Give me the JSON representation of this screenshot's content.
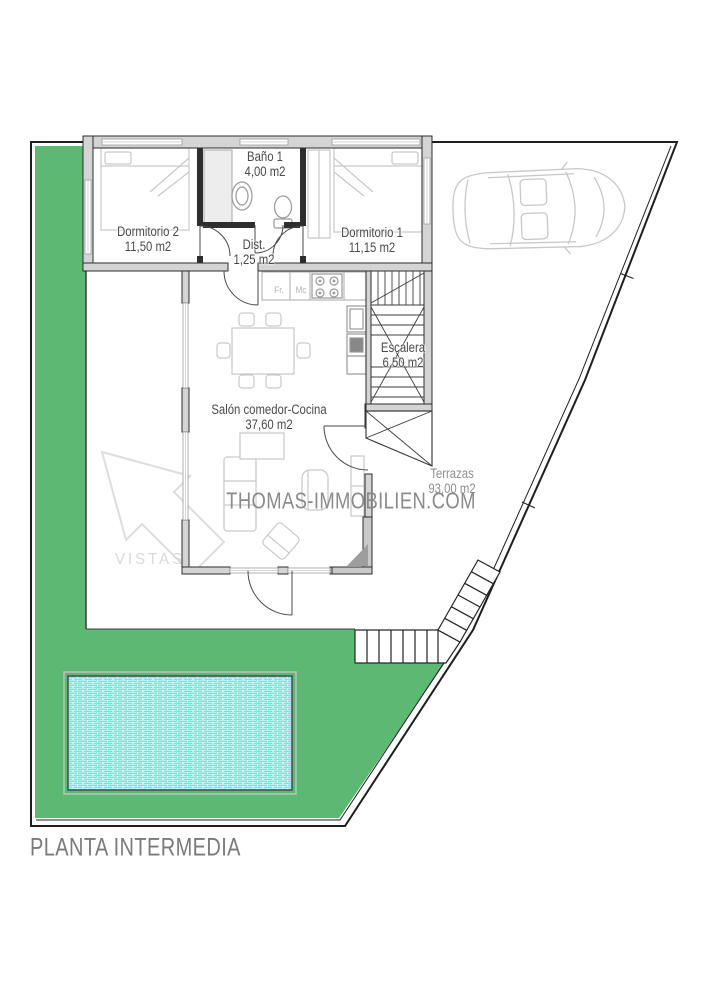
{
  "title": "PLANTA INTERMEDIA",
  "watermark": "THOMAS-IMMOBILIEN.COM",
  "rooms": [
    {
      "label": "Dormitorio 2",
      "area": "11,50 m2"
    },
    {
      "label": "Baño 1",
      "area": "4,00 m2"
    },
    {
      "label": "Dist.",
      "area": "1,25 m2"
    },
    {
      "label": "Dormitorio 1",
      "area": "11,15 m2"
    },
    {
      "label": "Salón comedor-Cocina",
      "area": "37,60 m2"
    },
    {
      "label": "Escalera",
      "area": "6,50 m2"
    },
    {
      "label": "Terrazas",
      "area": "93,00 m2"
    }
  ],
  "annotations": {
    "vistas": "VISTAS",
    "kitchen_fridge": "Fr.",
    "kitchen_micro": "Mc"
  },
  "colors": {
    "lawn": "#5cb973",
    "pool_water": "#5fe6e4",
    "wall_dark": "#2e2e2e",
    "wall_fill": "#d4d4d4",
    "furniture": "#c9c9c9",
    "label": "#4a4a4a",
    "muted_label": "#8f8f8f",
    "watermark": "#8a8a8a",
    "title": "#7a7a7a"
  }
}
